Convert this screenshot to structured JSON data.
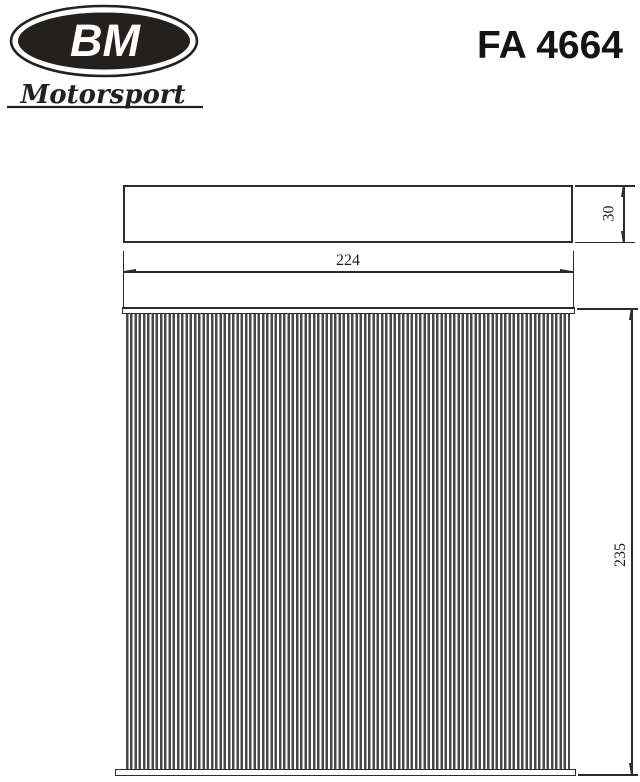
{
  "header": {
    "logo_primary": "BM",
    "logo_secondary": "Motorsport",
    "part_number": "FA 4664"
  },
  "drawing": {
    "description": "cabin-air-filter technical drawing, side view and pleated front view",
    "dim_width": "224",
    "dim_depth": "30",
    "dim_height": "235"
  },
  "colors": {
    "ink": "#24201d",
    "line": "#2b2b2b",
    "pleat_stripe": "#484848",
    "background": "#ffffff"
  }
}
